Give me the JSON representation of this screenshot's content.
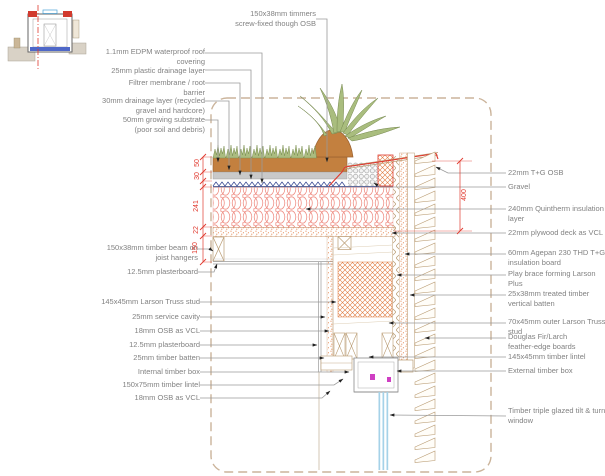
{
  "labels_left": [
    "150x38mm timmers\nscrew-fixed though OSB",
    "1.1mm EDPM waterproof roof\ncovering",
    "25mm plastic drainage layer",
    "Filtrer membrane / root\nbarrier",
    "30mm drainage layer (recycled\ngravel and hardcore)",
    "50mm growing substrate\n(poor soil and debris)",
    "150x38mm timber beam on\njoist hangers",
    "12.5mm plasterboard",
    "145x45mm Larson Truss stud",
    "25mm service cavity",
    "18mm OSB as VCL",
    "12.5mm plasterboard",
    "25mm timber batten",
    "Internal timber box",
    "150x75mm timber lintel",
    "18mm OSB as VCL"
  ],
  "labels_right": [
    "22mm T+G OSB",
    "Gravel",
    "240mm Quintherm insulation\nlayer",
    "22mm plywood deck as VCL",
    "60mm Agepan 230 THD T+G\ninsulation board",
    "Play brace forming Larson\nPlus",
    "25x38mm treated timber\nvertical batten",
    "70x45mm outer Larson Truss\nstud",
    "Douglas Fir/Larch\nfeather-edge boards",
    "145x45mm timber lintel",
    "External timber box",
    "Timber triple glazed tilt & turn\nwindow"
  ],
  "dims": {
    "substrate": "50",
    "drainage": "30",
    "insulation": "241",
    "deck": "22",
    "joist": "150",
    "wall": "400"
  },
  "colors": {
    "dimension_red": "#e0392e",
    "leader_gray": "#9a9a9a",
    "insulation_salmon": "#ef8f85",
    "timber_tan": "#b99b72",
    "hatch_orange": "#e07a3f",
    "soil_brown": "#c3803f",
    "plant_green": "#a9bd7e",
    "glazing_blue": "#a5d2e8",
    "boundary_tan": "#cbb49b"
  }
}
